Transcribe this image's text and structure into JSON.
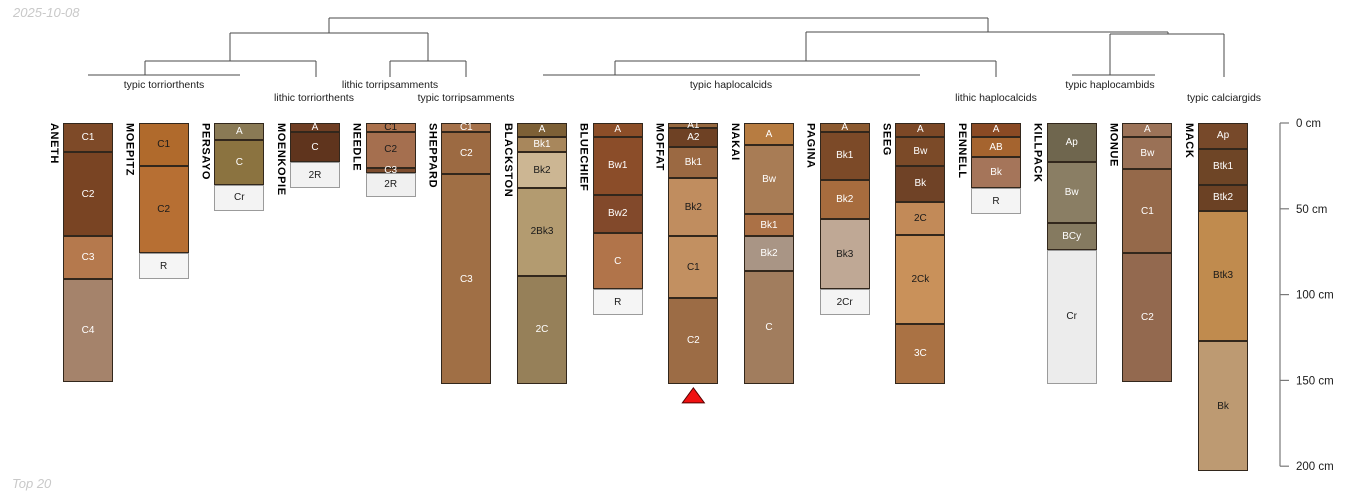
{
  "page": {
    "date_label": "2025-10-08",
    "footer_label": "Top 20",
    "background": "#ffffff"
  },
  "chart_data": {
    "type": "soil-profile-dendrogram",
    "depth_unit": "cm",
    "depth_axis": {
      "ticks": [
        {
          "depth": 0,
          "label": "0 cm"
        },
        {
          "depth": 50,
          "label": "50 cm"
        },
        {
          "depth": 100,
          "label": "100 cm"
        },
        {
          "depth": 150,
          "label": "150 cm"
        },
        {
          "depth": 200,
          "label": "200 cm"
        }
      ]
    },
    "groups": [
      {
        "label": "typic torriorthents",
        "profiles": [
          "ANETH",
          "MOEPITZ",
          "PERSAYO"
        ],
        "label_x": 164,
        "row": 1
      },
      {
        "label": "lithic torriorthents",
        "profiles": [
          "MOENKOPIE"
        ],
        "label_x": 314,
        "row": 2
      },
      {
        "label": "lithic torripsamments",
        "profiles": [
          "NEEDLE"
        ],
        "label_x": 390,
        "row": 1
      },
      {
        "label": "typic torripsamments",
        "profiles": [
          "SHEPPARD"
        ],
        "label_x": 466,
        "row": 2
      },
      {
        "label": "typic haplocalcids",
        "profiles": [
          "BLACKSTON",
          "BLUECHIEF",
          "MOFFAT",
          "NAKAI",
          "PAGINA",
          "SEEG"
        ],
        "label_x": 731,
        "row": 1
      },
      {
        "label": "lithic haplocalcids",
        "profiles": [
          "PENNELL"
        ],
        "label_x": 996,
        "row": 2
      },
      {
        "label": "typic haplocambids",
        "profiles": [
          "KILLPACK",
          "MONUE"
        ],
        "label_x": 1110,
        "row": 1
      },
      {
        "label": "typic calciargids",
        "profiles": [
          "MACK"
        ],
        "label_x": 1224,
        "row": 2
      }
    ],
    "dendrogram_segments": [
      [
        329,
        18,
        988,
        18
      ],
      [
        329,
        18,
        329,
        33
      ],
      [
        988,
        18,
        988,
        32
      ],
      [
        230,
        33,
        428,
        33
      ],
      [
        230,
        33,
        230,
        61
      ],
      [
        428,
        33,
        428,
        61
      ],
      [
        145,
        61,
        316,
        61
      ],
      [
        145,
        61,
        145,
        75
      ],
      [
        316,
        61,
        316,
        77
      ],
      [
        88,
        75,
        240,
        75
      ],
      [
        390,
        61,
        466,
        61
      ],
      [
        390,
        61,
        390,
        77
      ],
      [
        466,
        61,
        466,
        77
      ],
      [
        806,
        32,
        1168,
        32
      ],
      [
        806,
        32,
        806,
        61
      ],
      [
        1168,
        32,
        1168,
        34
      ],
      [
        1110,
        34,
        1224,
        34
      ],
      [
        1110,
        34,
        1110,
        75
      ],
      [
        1224,
        34,
        1224,
        77
      ],
      [
        615,
        61,
        996,
        61
      ],
      [
        615,
        61,
        615,
        75
      ],
      [
        996,
        61,
        996,
        77
      ],
      [
        543,
        75,
        920,
        75
      ],
      [
        1072,
        75,
        1155,
        75
      ]
    ],
    "profiles": [
      {
        "name": "ANETH",
        "horizons": [
          {
            "name": "C1",
            "top": 0,
            "bottom": 17,
            "color": "#7e4a28",
            "label_color": "#ffffff"
          },
          {
            "name": "C2",
            "top": 17,
            "bottom": 66,
            "color": "#794423",
            "label_color": "#ffffff"
          },
          {
            "name": "C3",
            "top": 66,
            "bottom": 91,
            "color": "#b5794d",
            "label_color": "#ffffff"
          },
          {
            "name": "C4",
            "top": 91,
            "bottom": 151,
            "color": "#a5836b",
            "label_color": "#ffffff"
          }
        ]
      },
      {
        "name": "MOEPITZ",
        "horizons": [
          {
            "name": "C1",
            "top": 0,
            "bottom": 25,
            "color": "#b06a2c",
            "label_color": "#1a1a1a"
          },
          {
            "name": "C2",
            "top": 25,
            "bottom": 76,
            "color": "#b76f33",
            "label_color": "#1a1a1a"
          },
          {
            "name": "R",
            "top": 76,
            "bottom": 91,
            "color": "#f5f5f5",
            "label_color": "#1a1a1a"
          }
        ]
      },
      {
        "name": "PERSAYO",
        "horizons": [
          {
            "name": "A",
            "top": 0,
            "bottom": 10,
            "color": "#8a7a55",
            "label_color": "#ffffff"
          },
          {
            "name": "C",
            "top": 10,
            "bottom": 36,
            "color": "#8b7340",
            "label_color": "#ffffff"
          },
          {
            "name": "Cr",
            "top": 36,
            "bottom": 51,
            "color": "#f3f3f3",
            "label_color": "#1a1a1a"
          }
        ]
      },
      {
        "name": "MOENKOPIE",
        "horizons": [
          {
            "name": "A",
            "top": 0,
            "bottom": 5,
            "color": "#6f3e23",
            "label_color": "#ffffff"
          },
          {
            "name": "C",
            "top": 5,
            "bottom": 23,
            "color": "#5f341d",
            "label_color": "#ffffff"
          },
          {
            "name": "2R",
            "top": 23,
            "bottom": 38,
            "color": "#f2f2f2",
            "label_color": "#1a1a1a"
          }
        ]
      },
      {
        "name": "NEEDLE",
        "horizons": [
          {
            "name": "C1",
            "top": 0,
            "bottom": 5,
            "color": "#ab714c",
            "label_color": "#1a1a1a"
          },
          {
            "name": "C2",
            "top": 5,
            "bottom": 26,
            "color": "#a56f4f",
            "label_color": "#1a1a1a"
          },
          {
            "name": "C3",
            "top": 26,
            "bottom": 29,
            "color": "#7c4c2e",
            "label_color": "#ffffff"
          },
          {
            "name": "2R",
            "top": 29,
            "bottom": 43,
            "color": "#f0f0f0",
            "label_color": "#1a1a1a"
          }
        ]
      },
      {
        "name": "SHEPPARD",
        "horizons": [
          {
            "name": "C1",
            "top": 0,
            "bottom": 5,
            "color": "#a5714a",
            "label_color": "#ffffff"
          },
          {
            "name": "C2",
            "top": 5,
            "bottom": 30,
            "color": "#9c6a42",
            "label_color": "#ffffff"
          },
          {
            "name": "C3",
            "top": 30,
            "bottom": 152,
            "color": "#a06f45",
            "label_color": "#ffffff"
          }
        ]
      },
      {
        "name": "BLACKSTON",
        "horizons": [
          {
            "name": "A",
            "top": 0,
            "bottom": 8,
            "color": "#7d6036",
            "label_color": "#ffffff"
          },
          {
            "name": "Bk1",
            "top": 8,
            "bottom": 17,
            "color": "#a8875c",
            "label_color": "#ffffff"
          },
          {
            "name": "Bk2",
            "top": 17,
            "bottom": 38,
            "color": "#ccb693",
            "label_color": "#1a1a1a"
          },
          {
            "name": "2Bk3",
            "top": 38,
            "bottom": 89,
            "color": "#b39b70",
            "label_color": "#1a1a1a"
          },
          {
            "name": "2C",
            "top": 89,
            "bottom": 152,
            "color": "#968059",
            "label_color": "#ffffff"
          }
        ]
      },
      {
        "name": "BLUECHIEF",
        "horizons": [
          {
            "name": "A",
            "top": 0,
            "bottom": 8,
            "color": "#8c4e28",
            "label_color": "#ffffff"
          },
          {
            "name": "Bw1",
            "top": 8,
            "bottom": 42,
            "color": "#8b4d29",
            "label_color": "#ffffff"
          },
          {
            "name": "Bw2",
            "top": 42,
            "bottom": 64,
            "color": "#82492b",
            "label_color": "#ffffff"
          },
          {
            "name": "C",
            "top": 64,
            "bottom": 97,
            "color": "#b1744a",
            "label_color": "#ffffff"
          },
          {
            "name": "R",
            "top": 97,
            "bottom": 112,
            "color": "#f5f5f5",
            "label_color": "#1a1a1a"
          }
        ]
      },
      {
        "name": "MOFFAT",
        "horizons": [
          {
            "name": "A1",
            "top": 0,
            "bottom": 3,
            "color": "#96683f",
            "label_color": "#ffffff"
          },
          {
            "name": "A2",
            "top": 3,
            "bottom": 14,
            "color": "#6e4124",
            "label_color": "#ffffff"
          },
          {
            "name": "Bk1",
            "top": 14,
            "bottom": 32,
            "color": "#9b6942",
            "label_color": "#ffffff"
          },
          {
            "name": "Bk2",
            "top": 32,
            "bottom": 66,
            "color": "#c08d5f",
            "label_color": "#1a1a1a"
          },
          {
            "name": "C1",
            "top": 66,
            "bottom": 102,
            "color": "#c29061",
            "label_color": "#1a1a1a"
          },
          {
            "name": "C2",
            "top": 102,
            "bottom": 152,
            "color": "#9c6c45",
            "label_color": "#ffffff"
          }
        ]
      },
      {
        "name": "NAKAI",
        "horizons": [
          {
            "name": "A",
            "top": 0,
            "bottom": 13,
            "color": "#b77c41",
            "label_color": "#ffffff"
          },
          {
            "name": "Bw",
            "top": 13,
            "bottom": 53,
            "color": "#a87c55",
            "label_color": "#ffffff"
          },
          {
            "name": "Bk1",
            "top": 53,
            "bottom": 66,
            "color": "#ab7146",
            "label_color": "#ffffff"
          },
          {
            "name": "Bk2",
            "top": 66,
            "bottom": 86,
            "color": "#a99585",
            "label_color": "#ffffff"
          },
          {
            "name": "C",
            "top": 86,
            "bottom": 152,
            "color": "#a17d5e",
            "label_color": "#ffffff"
          }
        ]
      },
      {
        "name": "PAGINA",
        "horizons": [
          {
            "name": "A",
            "top": 0,
            "bottom": 5,
            "color": "#8c5a30",
            "label_color": "#ffffff"
          },
          {
            "name": "Bk1",
            "top": 5,
            "bottom": 33,
            "color": "#7c4a28",
            "label_color": "#ffffff"
          },
          {
            "name": "Bk2",
            "top": 33,
            "bottom": 56,
            "color": "#a76c3e",
            "label_color": "#ffffff"
          },
          {
            "name": "Bk3",
            "top": 56,
            "bottom": 97,
            "color": "#bfa895",
            "label_color": "#1a1a1a"
          },
          {
            "name": "2Cr",
            "top": 97,
            "bottom": 112,
            "color": "#f4f4f4",
            "label_color": "#1a1a1a"
          }
        ]
      },
      {
        "name": "SEEG",
        "horizons": [
          {
            "name": "A",
            "top": 0,
            "bottom": 8,
            "color": "#7c4826",
            "label_color": "#ffffff"
          },
          {
            "name": "Bw",
            "top": 8,
            "bottom": 25,
            "color": "#7b4a28",
            "label_color": "#ffffff"
          },
          {
            "name": "Bk",
            "top": 25,
            "bottom": 46,
            "color": "#6f4226",
            "label_color": "#ffffff"
          },
          {
            "name": "2C",
            "top": 46,
            "bottom": 65,
            "color": "#c28a58",
            "label_color": "#1a1a1a"
          },
          {
            "name": "2Ck",
            "top": 65,
            "bottom": 117,
            "color": "#c9915a",
            "label_color": "#1a1a1a"
          },
          {
            "name": "3C",
            "top": 117,
            "bottom": 152,
            "color": "#aa7244",
            "label_color": "#ffffff"
          }
        ]
      },
      {
        "name": "PENNELL",
        "horizons": [
          {
            "name": "A",
            "top": 0,
            "bottom": 8,
            "color": "#8a4a24",
            "label_color": "#ffffff"
          },
          {
            "name": "AB",
            "top": 8,
            "bottom": 20,
            "color": "#a5642f",
            "label_color": "#ffffff"
          },
          {
            "name": "Bk",
            "top": 20,
            "bottom": 38,
            "color": "#a5755a",
            "label_color": "#ffffff"
          },
          {
            "name": "R",
            "top": 38,
            "bottom": 53,
            "color": "#f4f4f4",
            "label_color": "#1a1a1a"
          }
        ]
      },
      {
        "name": "KILLPACK",
        "horizons": [
          {
            "name": "Ap",
            "top": 0,
            "bottom": 23,
            "color": "#6f664e",
            "label_color": "#ffffff"
          },
          {
            "name": "Bw",
            "top": 23,
            "bottom": 58,
            "color": "#8a7e64",
            "label_color": "#ffffff"
          },
          {
            "name": "BCy",
            "top": 58,
            "bottom": 74,
            "color": "#857a60",
            "label_color": "#ffffff"
          },
          {
            "name": "Cr",
            "top": 74,
            "bottom": 152,
            "color": "#ececec",
            "label_color": "#1a1a1a"
          }
        ]
      },
      {
        "name": "MONUE",
        "horizons": [
          {
            "name": "A",
            "top": 0,
            "bottom": 8,
            "color": "#9c7358",
            "label_color": "#ffffff"
          },
          {
            "name": "Bw",
            "top": 8,
            "bottom": 27,
            "color": "#9a7156",
            "label_color": "#ffffff"
          },
          {
            "name": "C1",
            "top": 27,
            "bottom": 76,
            "color": "#95694a",
            "label_color": "#ffffff"
          },
          {
            "name": "C2",
            "top": 76,
            "bottom": 151,
            "color": "#93694f",
            "label_color": "#ffffff"
          }
        ]
      },
      {
        "name": "MACK",
        "horizons": [
          {
            "name": "Ap",
            "top": 0,
            "bottom": 15,
            "color": "#77492a",
            "label_color": "#ffffff"
          },
          {
            "name": "Btk1",
            "top": 15,
            "bottom": 36,
            "color": "#6e4526",
            "label_color": "#ffffff"
          },
          {
            "name": "Btk2",
            "top": 36,
            "bottom": 51,
            "color": "#6b4124",
            "label_color": "#ffffff"
          },
          {
            "name": "Btk3",
            "top": 51,
            "bottom": 127,
            "color": "#c08b4e",
            "label_color": "#1a1a1a"
          },
          {
            "name": "Bk",
            "top": 127,
            "bottom": 203,
            "color": "#bd9a72",
            "label_color": "#1a1a1a"
          }
        ]
      }
    ],
    "marker": {
      "profile": "MOFFAT",
      "shape": "triangle-up",
      "fill": "#f01111",
      "stroke": "#550000"
    },
    "layout": {
      "width": 1350,
      "height": 500,
      "depth_top_y": 123,
      "px_per_cm": 1.716,
      "first_center_x": 88,
      "center_spacing": 75.67,
      "profile_width": 50,
      "axis_x": 1280,
      "axis_tick_len": 9,
      "axis_label_x": 1296,
      "group_row1_y": 79,
      "group_row2_y": 92,
      "line_color": "#4a4a4a",
      "axis_color": "#787878",
      "horizon_border": "#32271c",
      "light_horizon_border": "#9b9b9b"
    }
  }
}
